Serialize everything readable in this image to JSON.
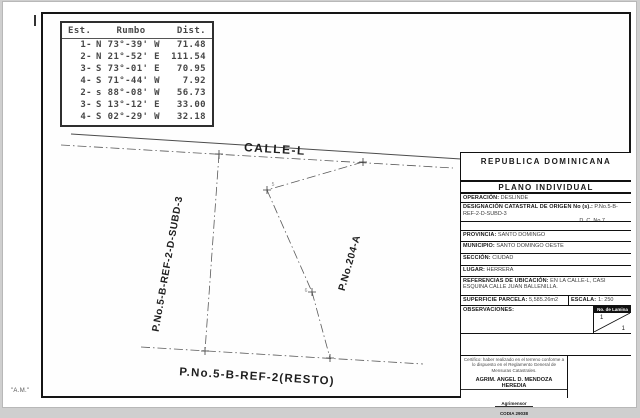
{
  "page": {
    "corner_note": "\"A.M.\""
  },
  "bearing_table": {
    "col_est": "Est.",
    "col_rumbo": "Rumbo",
    "col_dist": "Dist.",
    "rows": [
      {
        "est": "1-",
        "rumbo": "N 73°-39' W",
        "dist": "71.48"
      },
      {
        "est": "2-",
        "rumbo": "N 21°-52' E",
        "dist": "111.54"
      },
      {
        "est": "3-",
        "rumbo": "S 73°-01' E",
        "dist": "70.95"
      },
      {
        "est": "4-",
        "rumbo": "S 71°-44' W",
        "dist": "7.92"
      },
      {
        "est": "2-",
        "rumbo": "s 88°-08' W",
        "dist": "56.73"
      },
      {
        "est": "3-",
        "rumbo": "S 13°-12' E",
        "dist": "33.00"
      },
      {
        "est": "4-",
        "rumbo": "S 02°-29' W",
        "dist": "32.18"
      }
    ]
  },
  "plot": {
    "street_label": "CALLE-L",
    "left_parcel": "P.No.5-B-REF-2-D-SUBD-3",
    "right_parcel": "P.No.204-A",
    "bottom_parcel": "P.No.5-B-REF-2(RESTO)",
    "vertex_label_a": "5",
    "vertex_label_b": "6"
  },
  "title_block": {
    "country": "REPUBLICA  DOMINICANA",
    "plan_type": "PLANO INDIVIDUAL",
    "operacion_label": "OPERACIÓN:",
    "operacion_value": "DESLINDE",
    "designacion_label": "DESIGNACIÓN CATASTRAL DE ORIGEN No (s).:",
    "designacion_value": "P.No.5-B-REF-2-D-SUBD-3",
    "designacion_value2": "D. C. No.7",
    "provincia_label": "PROVINCIA:",
    "provincia_value": "SANTO DOMINGO",
    "municipio_label": "MUNICIPIO:",
    "municipio_value": "SANTO DOMINGO OESTE",
    "seccion_label": "SECCIÓN:",
    "seccion_value": "CIUDAD",
    "lugar_label": "LUGAR:",
    "lugar_value": "HERRERA",
    "referencias_label": "REFERENCIAS DE UBICACIÓN:",
    "referencias_value": "EN LA CALLE-L, CASI ESQUINA CALLE JUAN BALLENILLA.",
    "superficie_label": "SUPERFICIE PARCELA:",
    "superficie_value": "5,585.26m2",
    "escala_label": "ESCALA:",
    "escala_value": "1: 250",
    "observaciones_label": "OBSERVACIONES:",
    "lamina_label": "No. de Lamina",
    "lamina_top": "1",
    "lamina_bottom": "1",
    "cert_text": "Certifico: haber realizado en el terreno conforme a lo dispuesto en el Reglamento General de Mensuras Catastrales.",
    "surveyor_name": "AGRIM. ANGEL D. MENDOZA HEREDIA",
    "surveyor_title": "Agrimensor",
    "surveyor_codia": "CODIA 29038"
  }
}
